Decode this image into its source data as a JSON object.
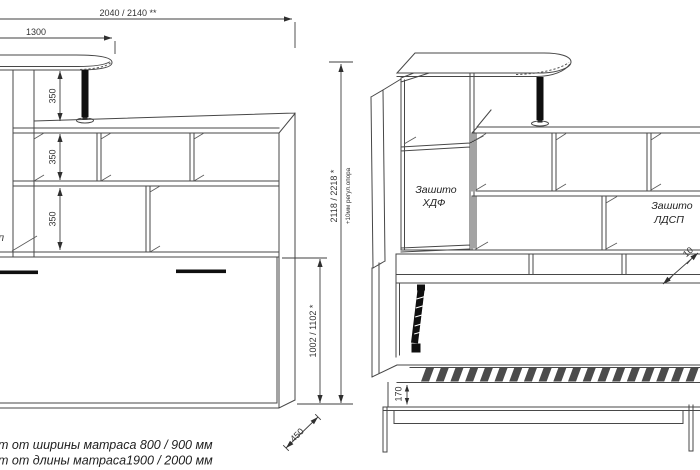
{
  "drawing": {
    "kind": "furniture technical drawing, wall bed with shelving, two projections",
    "colors": {
      "line": "#474747",
      "text": "#333333",
      "solid_black": "#0f0f0f",
      "background": "#ffffff"
    },
    "dimensions": {
      "total_width": "2040 / 2140 **",
      "tabletop_width": "1300",
      "shelf_gap_top": "350",
      "shelf_gap_middle": "350",
      "shelf_gap_bottom": "350",
      "total_height": "2118 / 2218 *",
      "height_note": "+10мм регул.опора",
      "bed_panel_height": "1002 / 1102 *",
      "depth": "450",
      "bed_frame_height": "170",
      "partial_right_edge": "10"
    },
    "labels": {
      "hdf_line1": "Зашито",
      "hdf_line2": "ХДФ",
      "ldsp_line1": "Зашито",
      "ldsp_line2": "ЛДСП",
      "left_edge_fragment": "п"
    },
    "footnotes": {
      "line1": "т от ширины матраса 800 / 900 мм",
      "line2": "т от длины матраса1900 / 2000 мм"
    }
  }
}
